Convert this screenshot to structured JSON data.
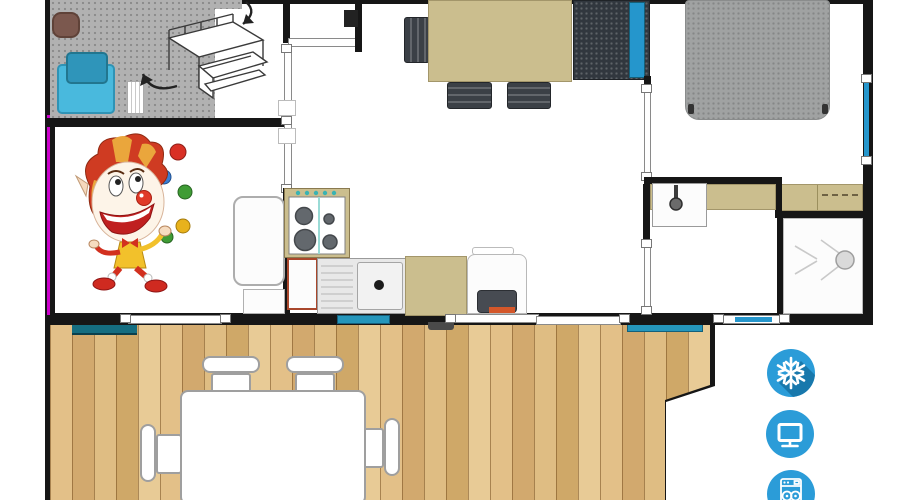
{
  "scene": {
    "type": "mobile-home-floor-plan",
    "width": 900,
    "height": 500,
    "background": "#ffffff",
    "has_text": false
  },
  "palette": {
    "wall": "#161616",
    "accent_blue": "#2b9cd8",
    "accent_blue_shadow": "#1878ac",
    "window_glass": "#2596cc",
    "counter_tan": "#cbbe8e",
    "carpet_grey": "#b1b1b1",
    "bed_grey": "#a0a2a2",
    "furniture_dark": "#3b4046",
    "bunk_blue_light": "#49b9dd",
    "bunk_blue_dark": "#2f95ba",
    "armchair_brown": "#7b584e",
    "magenta_marker": "#cc00cc",
    "deck_wood": "#e0c08b",
    "teal_step": "#156d80",
    "oven_trim_red": "#a9472c",
    "heater_orange": "#d4572a"
  },
  "house": {
    "rooms": [
      {
        "name": "kids-bedroom",
        "items": [
          "armchair",
          "bunk-bed-pillow",
          "bunk-bed-mattress",
          "ladder",
          "bunk-bed-sketch",
          "conversion-arrows",
          "carpet"
        ]
      },
      {
        "name": "living-dining",
        "items": [
          "dining-table",
          "dining-chairs",
          "wardrobe",
          "clown-illustration"
        ]
      },
      {
        "name": "kitchen",
        "items": [
          "fridge",
          "base-cabinet",
          "gas-hob",
          "oven",
          "sink-with-drainer",
          "counter",
          "white-appliance",
          "dark-heater"
        ]
      },
      {
        "name": "master-bedroom",
        "items": [
          "double-bed",
          "dresser",
          "side-window"
        ]
      },
      {
        "name": "bathroom",
        "items": [
          "washbasin",
          "vanity-counter",
          "shower"
        ]
      },
      {
        "name": "terrace",
        "items": [
          "wood-decking",
          "outdoor-table",
          "outdoor-chairs",
          "teal-steps"
        ]
      }
    ],
    "openings": [
      "left-window",
      "teal-window",
      "sliding-bay-door",
      "right-window",
      "bedroom-door",
      "bathroom-door",
      "kids-room-door",
      "hall-partition"
    ]
  },
  "amenity_icons": [
    {
      "name": "snowflake-icon"
    },
    {
      "name": "tv-icon"
    },
    {
      "name": "dishwasher-icon"
    }
  ]
}
